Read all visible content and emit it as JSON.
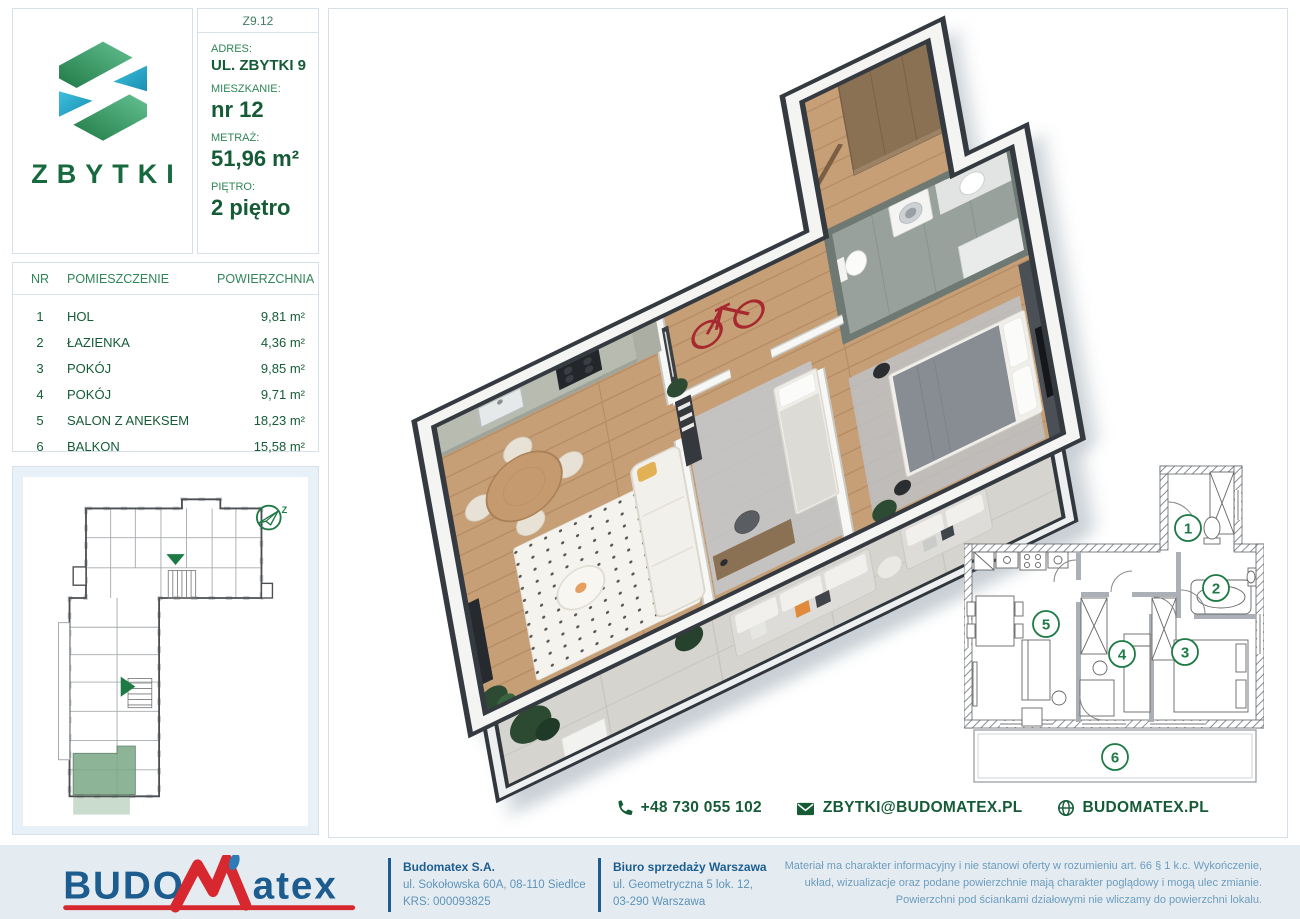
{
  "brand": {
    "project_name": "ZBYTKI",
    "unit_code": "Z9.12"
  },
  "info": {
    "address_label": "ADRES:",
    "address": "UL. ZBYTKI 9",
    "apartment_label": "MIESZKANIE:",
    "apartment": "nr 12",
    "area_label": "METRAŻ:",
    "area": "51,96 m²",
    "floor_label": "PIĘTRO:",
    "floor": "2 piętro"
  },
  "rooms_table": {
    "headers": [
      "NR",
      "POMIESZCZENIE",
      "POWIERZCHNIA"
    ],
    "rows": [
      [
        "1",
        "HOL",
        "9,81 m²"
      ],
      [
        "2",
        "ŁAZIENKA",
        "4,36 m²"
      ],
      [
        "3",
        "POKÓJ",
        "9,85 m²"
      ],
      [
        "4",
        "POKÓJ",
        "9,71 m²"
      ],
      [
        "5",
        "SALON Z ANEKSEM",
        "18,23 m²"
      ],
      [
        "6",
        "BALKON",
        "15,58 m²"
      ]
    ]
  },
  "site_plan": {
    "compass_label": "Z"
  },
  "floor_plan_2d": {
    "room_numbers": [
      "1",
      "2",
      "3",
      "4",
      "5",
      "6"
    ]
  },
  "contact": {
    "phone": "+48 730 055 102",
    "email": "ZBYTKI@BUDOMATEX.PL",
    "website": "BUDOMATEX.PL"
  },
  "footer": {
    "logo_text_1": "BUDO",
    "logo_text_2": "atex",
    "company_name": "Budomatex S.A.",
    "company_address": "ul. Sokołowska 60A, 08-110 Siedlce",
    "company_krs": "KRS: 000093825",
    "office_name": "Biuro sprzedaży Warszawa",
    "office_address": "ul. Geometryczna 5 lok. 12,",
    "office_city": "03-290 Warszawa",
    "disclaimer": "Materiał ma charakter informacyjny i nie stanowi oferty w rozumieniu art. 66 § 1 k.c. Wykończenie, układ, wizualizacje oraz podane powierzchnie mają charakter poglądowy i mogą ulec zmianie. Powierzchni pod ściankami działowymi nie wliczamy do powierzchni lokalu."
  },
  "colors": {
    "brand_green": "#17663a",
    "label_green": "#2f8656",
    "brand_blue": "#1d5c8f",
    "logo_red": "#d7282f",
    "footer_text_blue": "#5e93b8",
    "panel_blue_bg": "#e9f1f8"
  }
}
